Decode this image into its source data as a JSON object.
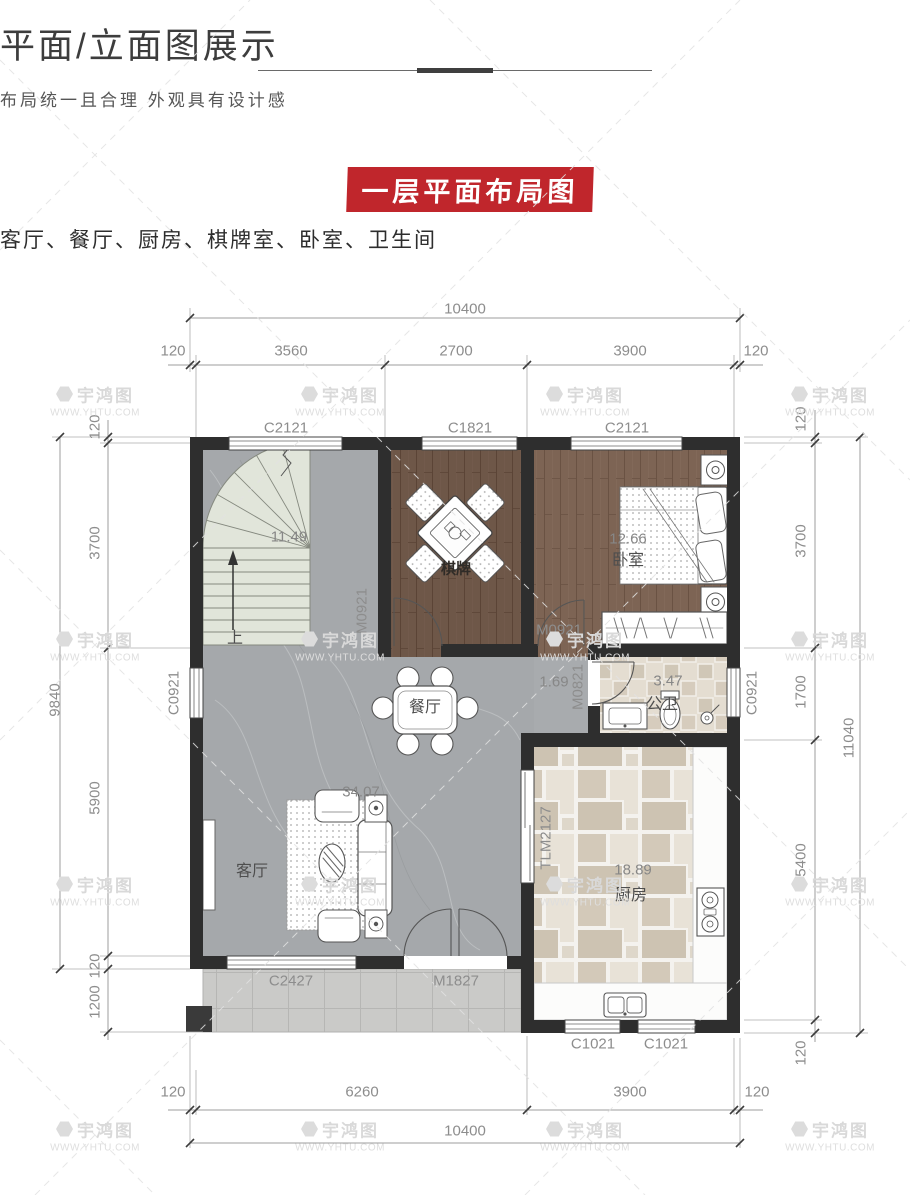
{
  "header": {
    "title": "平面/立面图展示",
    "subtitle": "布局统一且合理  外观具有设计感",
    "banner": "一层平面布局图",
    "banner_color": "#c0262c",
    "room_list": "客厅、餐厅、厨房、棋牌室、卧室、卫生间"
  },
  "watermark": {
    "name": "宇鸿图",
    "url": "WWW.YHTU.COM",
    "positions": [
      [
        95,
        400
      ],
      [
        340,
        400
      ],
      [
        585,
        400
      ],
      [
        830,
        400
      ],
      [
        95,
        645
      ],
      [
        340,
        645
      ],
      [
        585,
        645
      ],
      [
        830,
        645
      ],
      [
        95,
        890
      ],
      [
        340,
        890
      ],
      [
        585,
        890
      ],
      [
        830,
        890
      ],
      [
        95,
        1135
      ],
      [
        340,
        1135
      ],
      [
        585,
        1135
      ],
      [
        830,
        1135
      ]
    ]
  },
  "plan": {
    "labels": [
      {
        "t": "10400",
        "x": 465,
        "y": 309,
        "k": "dim"
      },
      {
        "t": "120",
        "x": 173,
        "y": 351,
        "k": "dim"
      },
      {
        "t": "3560",
        "x": 291,
        "y": 351,
        "k": "dim"
      },
      {
        "t": "2700",
        "x": 456,
        "y": 351,
        "k": "dim"
      },
      {
        "t": "3900",
        "x": 630,
        "y": 351,
        "k": "dim"
      },
      {
        "t": "120",
        "x": 756,
        "y": 351,
        "k": "dim"
      },
      {
        "t": "9840",
        "x": 55,
        "y": 700,
        "r": -90,
        "k": "dim"
      },
      {
        "t": "120",
        "x": 95,
        "y": 427,
        "r": -90,
        "k": "dim"
      },
      {
        "t": "3700",
        "x": 95,
        "y": 543,
        "r": -90,
        "k": "dim"
      },
      {
        "t": "5900",
        "x": 95,
        "y": 798,
        "r": -90,
        "k": "dim"
      },
      {
        "t": "120",
        "x": 95,
        "y": 966,
        "r": -90,
        "k": "dim"
      },
      {
        "t": "1200",
        "x": 95,
        "y": 1002,
        "r": -90,
        "k": "dim"
      },
      {
        "t": "120",
        "x": 801,
        "y": 419,
        "r": -90,
        "k": "dim"
      },
      {
        "t": "3700",
        "x": 801,
        "y": 541,
        "r": -90,
        "k": "dim"
      },
      {
        "t": "1700",
        "x": 801,
        "y": 692,
        "r": -90,
        "k": "dim"
      },
      {
        "t": "5400",
        "x": 801,
        "y": 860,
        "r": -90,
        "k": "dim"
      },
      {
        "t": "120",
        "x": 801,
        "y": 1053,
        "r": -90,
        "k": "dim"
      },
      {
        "t": "11040",
        "x": 849,
        "y": 738,
        "r": -90,
        "k": "dim"
      },
      {
        "t": "120",
        "x": 173,
        "y": 1092,
        "k": "dim"
      },
      {
        "t": "6260",
        "x": 362,
        "y": 1092,
        "k": "dim"
      },
      {
        "t": "3900",
        "x": 630,
        "y": 1092,
        "k": "dim"
      },
      {
        "t": "120",
        "x": 757,
        "y": 1092,
        "k": "dim"
      },
      {
        "t": "10400",
        "x": 465,
        "y": 1131,
        "k": "dim"
      },
      {
        "t": "C2121",
        "x": 286,
        "y": 428,
        "k": "open"
      },
      {
        "t": "C1821",
        "x": 470,
        "y": 428,
        "k": "open"
      },
      {
        "t": "C2121",
        "x": 627,
        "y": 428,
        "k": "open"
      },
      {
        "t": "C0921",
        "x": 174,
        "y": 693,
        "r": -90,
        "k": "open"
      },
      {
        "t": "C0921",
        "x": 752,
        "y": 693,
        "r": -90,
        "k": "open"
      },
      {
        "t": "M0921",
        "x": 362,
        "y": 611,
        "r": -90,
        "k": "open"
      },
      {
        "t": "M0921",
        "x": 559,
        "y": 630,
        "k": "open"
      },
      {
        "t": "M0821",
        "x": 578,
        "y": 687,
        "r": -90,
        "k": "open"
      },
      {
        "t": "TLM2127",
        "x": 546,
        "y": 838,
        "r": -90,
        "k": "open"
      },
      {
        "t": "C2427",
        "x": 291,
        "y": 981,
        "k": "open"
      },
      {
        "t": "M1827",
        "x": 456,
        "y": 981,
        "k": "open"
      },
      {
        "t": "C1021",
        "x": 593,
        "y": 1044,
        "k": "open"
      },
      {
        "t": "C1021",
        "x": 666,
        "y": 1044,
        "k": "open"
      },
      {
        "t": "11.49",
        "x": 289,
        "y": 537,
        "k": "num"
      },
      {
        "t": "上",
        "x": 235,
        "y": 636,
        "k": "name"
      },
      {
        "t": "棋牌",
        "x": 456,
        "y": 568,
        "k": "namew"
      },
      {
        "t": "12.66",
        "x": 628,
        "y": 539,
        "k": "num"
      },
      {
        "t": "卧室",
        "x": 628,
        "y": 558,
        "k": "name"
      },
      {
        "t": "餐厅",
        "x": 425,
        "y": 705,
        "k": "name"
      },
      {
        "t": "1.69",
        "x": 554,
        "y": 682,
        "k": "num"
      },
      {
        "t": "3.47",
        "x": 668,
        "y": 681,
        "k": "num"
      },
      {
        "t": "公卫",
        "x": 662,
        "y": 702,
        "k": "name"
      },
      {
        "t": "34.07",
        "x": 361,
        "y": 792,
        "k": "num"
      },
      {
        "t": "客厅",
        "x": 252,
        "y": 869,
        "k": "name"
      },
      {
        "t": "18.89",
        "x": 633,
        "y": 870,
        "k": "num"
      },
      {
        "t": "厨房",
        "x": 631,
        "y": 893,
        "k": "name"
      }
    ]
  }
}
